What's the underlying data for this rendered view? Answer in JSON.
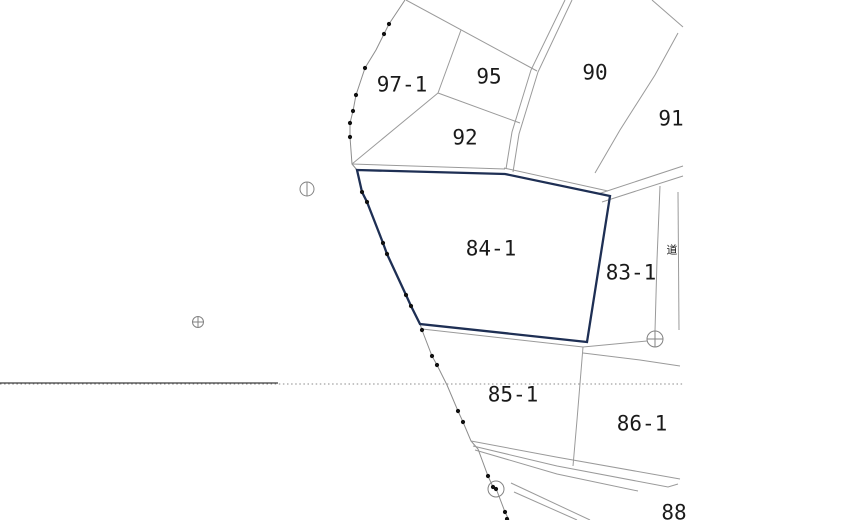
{
  "map": {
    "background": "#ffffff",
    "line_color": "#9a9a9a",
    "highlight_color": "#1e2f54",
    "text_color": "#1a1a1a",
    "parcels": [
      {
        "id": "97-1",
        "label": "97-1",
        "x": 402,
        "y": 85,
        "highlighted": false
      },
      {
        "id": "95",
        "label": "95",
        "x": 489,
        "y": 77,
        "highlighted": false
      },
      {
        "id": "90",
        "label": "90",
        "x": 595,
        "y": 73,
        "highlighted": false
      },
      {
        "id": "91",
        "label": "91",
        "x": 671,
        "y": 119,
        "highlighted": false
      },
      {
        "id": "92",
        "label": "92",
        "x": 465,
        "y": 138,
        "highlighted": false
      },
      {
        "id": "84-1",
        "label": "84-1",
        "x": 491,
        "y": 249,
        "highlighted": true
      },
      {
        "id": "83-1",
        "label": "83-1",
        "x": 631,
        "y": 273,
        "highlighted": false
      },
      {
        "id": "85-1",
        "label": "85-1",
        "x": 513,
        "y": 395,
        "highlighted": false
      },
      {
        "id": "86-1",
        "label": "86-1",
        "x": 642,
        "y": 424,
        "highlighted": false
      },
      {
        "id": "88",
        "label": "88",
        "x": 674,
        "y": 513,
        "highlighted": false
      }
    ],
    "road_label": {
      "label": "道",
      "x": 672,
      "y": 250
    },
    "markers": [
      {
        "name": "survey-marker-circle-cross",
        "type": "circle-cross",
        "x": 198,
        "y": 322,
        "r": 5.5
      },
      {
        "name": "survey-marker-circle-vline",
        "type": "circle-vline",
        "x": 307,
        "y": 189,
        "r": 7
      },
      {
        "name": "survey-marker-circle-cross",
        "type": "circle-cross",
        "x": 655,
        "y": 339,
        "r": 8
      },
      {
        "name": "survey-marker-circle-dot",
        "type": "circle-dot",
        "x": 496,
        "y": 489,
        "r": 8
      }
    ],
    "boundary_dots": [
      [
        389,
        24
      ],
      [
        384,
        34
      ],
      [
        365,
        68
      ],
      [
        356,
        95
      ],
      [
        353,
        111
      ],
      [
        350,
        123
      ],
      [
        350,
        137
      ],
      [
        362,
        192
      ],
      [
        367,
        202
      ],
      [
        383,
        243
      ],
      [
        387,
        254
      ],
      [
        406,
        295
      ],
      [
        411,
        306
      ],
      [
        422,
        330
      ],
      [
        432,
        356
      ],
      [
        437,
        365
      ],
      [
        458,
        411
      ],
      [
        463,
        422
      ],
      [
        488,
        476
      ],
      [
        493,
        487
      ],
      [
        505,
        512
      ],
      [
        507,
        519
      ]
    ]
  }
}
